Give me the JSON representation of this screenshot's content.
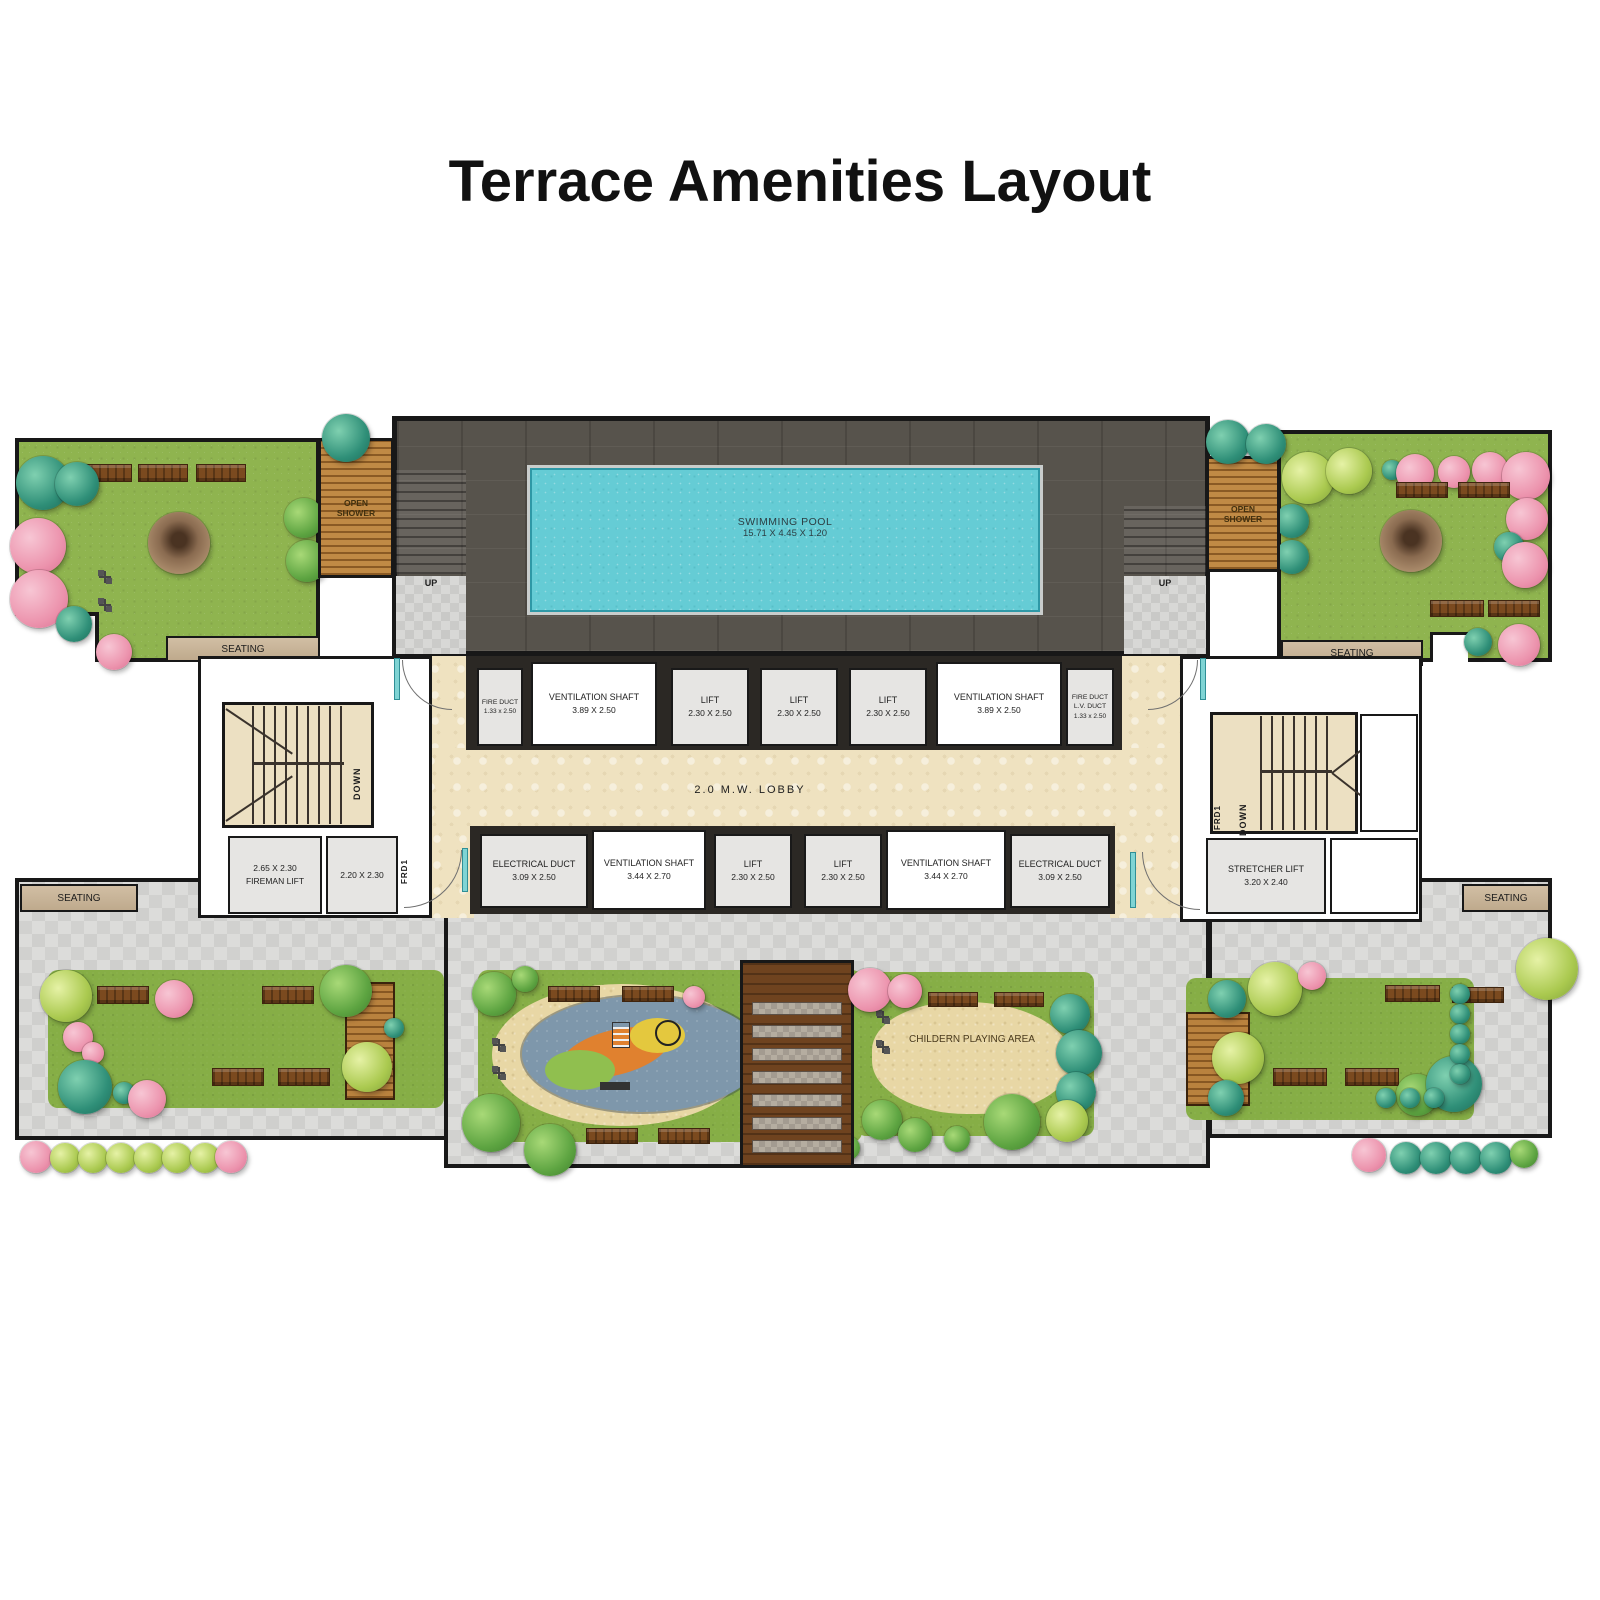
{
  "title": "Terrace Amenities Layout",
  "pool": {
    "name": "SWIMMING POOL",
    "dims": "15.71 X 4.45 X 1.20"
  },
  "pool_deck": {
    "up": "UP"
  },
  "open_shower": {
    "line1": "OPEN",
    "line2": "SHOWER"
  },
  "lobby": {
    "label": "2.0 M.W. LOBBY"
  },
  "core": {
    "down": "DOWN",
    "frd": "FRD1"
  },
  "seating_label": "SEATING",
  "children_area_label": "CHILDERN PLAYING AREA",
  "shafts_top": [
    {
      "name": "FIRE DUCT",
      "dims": "1.33 x 2.50"
    },
    {
      "name": "VENTILATION SHAFT",
      "dims": "3.89 X 2.50"
    },
    {
      "name": "LIFT",
      "dims": "2.30 X 2.50"
    },
    {
      "name": "LIFT",
      "dims": "2.30 X 2.50"
    },
    {
      "name": "LIFT",
      "dims": "2.30 X 2.50"
    },
    {
      "name": "VENTILATION SHAFT",
      "dims": "3.89 X 2.50"
    },
    {
      "line1": "FIRE DUCT",
      "line2": "L.V. DUCT",
      "dims": "1.33 x 2.50"
    }
  ],
  "shafts_bottom": [
    {
      "name": "ELECTRICAL DUCT",
      "dims": "3.09 X 2.50"
    },
    {
      "name": "VENTILATION SHAFT",
      "dims": "3.44 X 2.70"
    },
    {
      "name": "LIFT",
      "dims": "2.30 X 2.50"
    },
    {
      "name": "LIFT",
      "dims": "2.30 X 2.50"
    },
    {
      "name": "VENTILATION SHAFT",
      "dims": "3.44 X 2.70"
    },
    {
      "name": "ELECTRICAL DUCT",
      "dims": "3.09 X 2.50"
    }
  ],
  "left_core": {
    "fireman_dims": "2.65 X 2.30",
    "fireman_name": "FIREMAN LIFT",
    "service_dims": "2.20 X 2.30"
  },
  "right_core": {
    "stretcher_name": "STRETCHER LIFT",
    "stretcher_dims": "3.20 X 2.40"
  },
  "colors": {
    "pool": "#65ccd5",
    "pool_deck": "#57534c",
    "grass": "#8fb44f",
    "pavement": "#dcdcda",
    "lobby_floor": "#efe2c0",
    "wood_deck": "#c08a45",
    "seating": "#c9b394",
    "bench": "#7b4a1f",
    "pink_tree": "#ec93ad",
    "teal_tree": "#2f8f78",
    "playground": "#7e97ab"
  }
}
